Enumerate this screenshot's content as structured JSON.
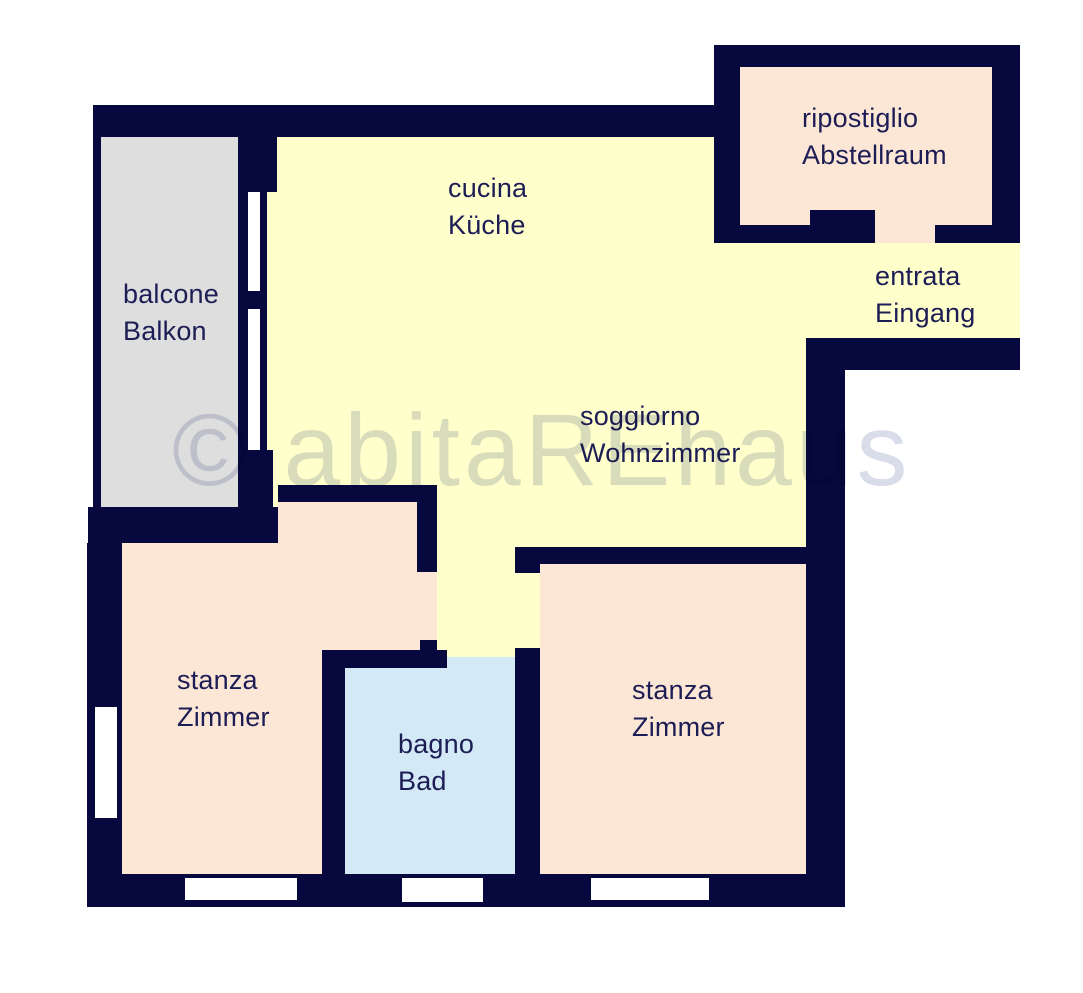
{
  "watermark": "© abitaREhaus",
  "colors": {
    "wall": "#06083e",
    "living": "#ffffcc",
    "bedroom": "#fce6d5",
    "bath": "#d3e9f6",
    "balcony": "#dedede",
    "text": "#1d1d55",
    "watermark": "#d9dce9",
    "bg": "#ffffff"
  },
  "rooms": [
    {
      "id": "balcone",
      "label_it": "balcone",
      "label_de": "Balkon"
    },
    {
      "id": "cucina",
      "label_it": "cucina",
      "label_de": "Küche"
    },
    {
      "id": "ripostiglio",
      "label_it": "ripostiglio",
      "label_de": "Abstellraum"
    },
    {
      "id": "entrata",
      "label_it": "entrata",
      "label_de": "Eingang"
    },
    {
      "id": "soggiorno",
      "label_it": "soggiorno",
      "label_de": "Wohnzimmer"
    },
    {
      "id": "stanza-left",
      "label_it": "stanza",
      "label_de": "Zimmer"
    },
    {
      "id": "bagno",
      "label_it": "bagno",
      "label_de": "Bad"
    },
    {
      "id": "stanza-right",
      "label_it": "stanza",
      "label_de": "Zimmer"
    }
  ]
}
